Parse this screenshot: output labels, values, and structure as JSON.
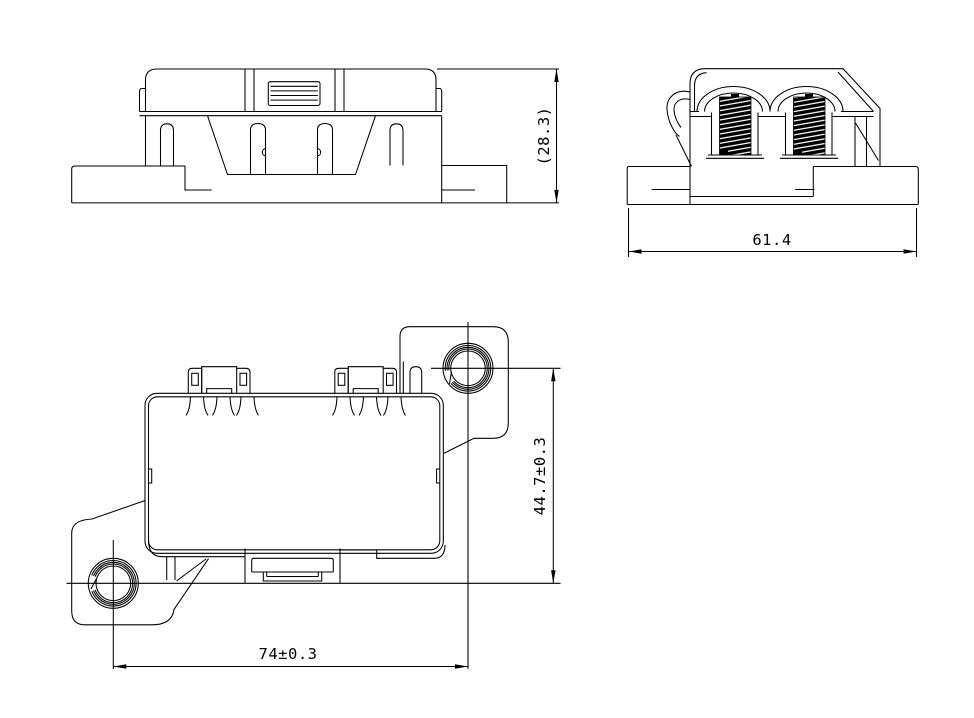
{
  "drawing": {
    "background_color": "#ffffff",
    "line_color": "#000000",
    "views": [
      {
        "name": "front-view",
        "dimensions": [
          {
            "label": "(28.3)",
            "orientation": "vertical",
            "position": "right"
          }
        ]
      },
      {
        "name": "side-view",
        "dimensions": [
          {
            "label": "61.4",
            "orientation": "horizontal",
            "position": "below"
          }
        ]
      },
      {
        "name": "top-view",
        "dimensions": [
          {
            "label": "44.7±0.3",
            "orientation": "vertical",
            "position": "right"
          },
          {
            "label": "74±0.3",
            "orientation": "horizontal",
            "position": "below"
          }
        ]
      }
    ]
  }
}
